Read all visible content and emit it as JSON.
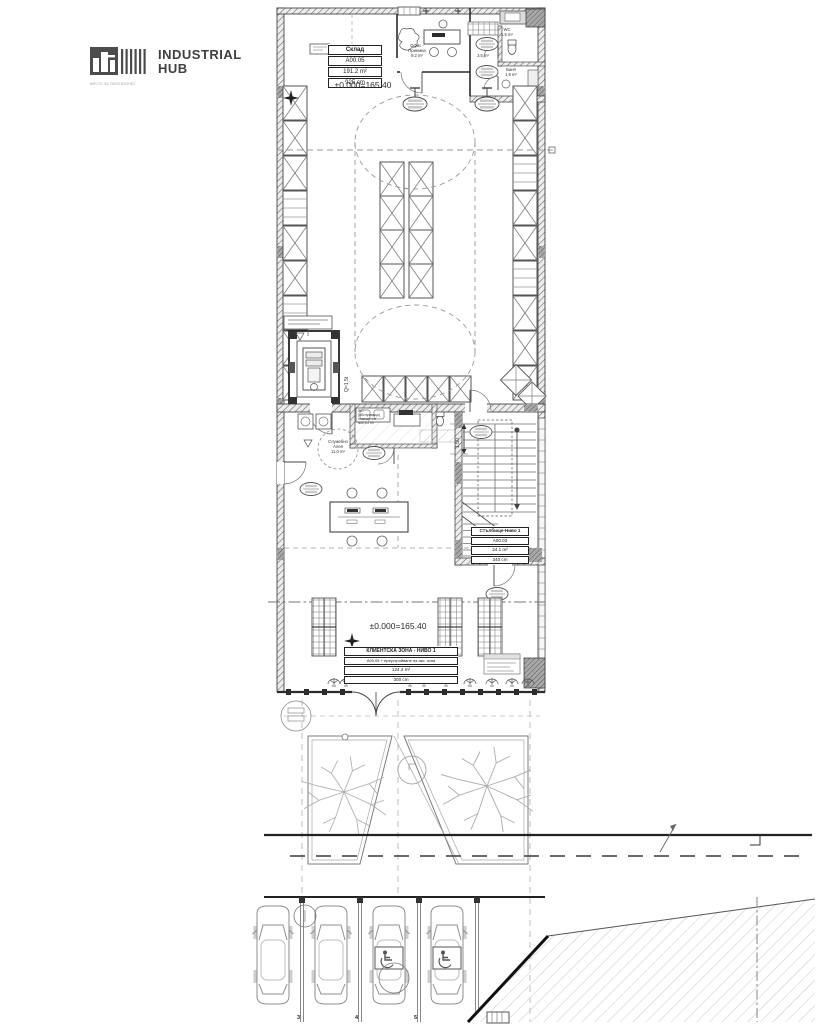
{
  "logo": {
    "name_line1": "INDUSTRIAL",
    "name_line2": "HUB",
    "tagline": "МЯСТО ЗА ТВОЯ БИЗНЕС"
  },
  "plan": {
    "levels": {
      "storage": "±0.000=165.40",
      "client": "±0.000=165.40"
    },
    "rooms": {
      "storage_table": {
        "name": "Склад",
        "number": "A00.05",
        "area": "191.2 m²",
        "height": "925 cm"
      },
      "stairs_table": {
        "name": "Стълбище-Ниво 1",
        "number": "A00.03",
        "area": "24.1 m²",
        "height": "340 cm"
      },
      "client_table": {
        "name": "КЛИЕНТСКА ЗОНА - НИВО 1",
        "number": "А00.05 + преустройване на акс. зона",
        "area": "124.2 m²",
        "height": "300 cm"
      },
      "office": {
        "name_line1": "Офис -",
        "name_line2": "Приемна",
        "area": "9.2 m²"
      },
      "room_35": {
        "area": "3.5 m²"
      },
      "wc": {
        "name": "WC",
        "area": "1.5 m²"
      },
      "bath": {
        "name": "Баня",
        "area": "1.9 m²"
      },
      "service_alley": {
        "name_line1": "Служебно",
        "name_line2": "Алея",
        "area": "11.0 m²"
      },
      "service_wc": {
        "line1": "WC",
        "line2": "(обслужващо)",
        "line3": "помещение",
        "line4": "№6 3.2 m²"
      }
    },
    "lift": {
      "capacity": "Q=1.5t"
    },
    "dimensions": {
      "stair_width": "1.50"
    },
    "parking": {
      "stall_numbers": [
        "3",
        "4",
        "5"
      ]
    }
  }
}
